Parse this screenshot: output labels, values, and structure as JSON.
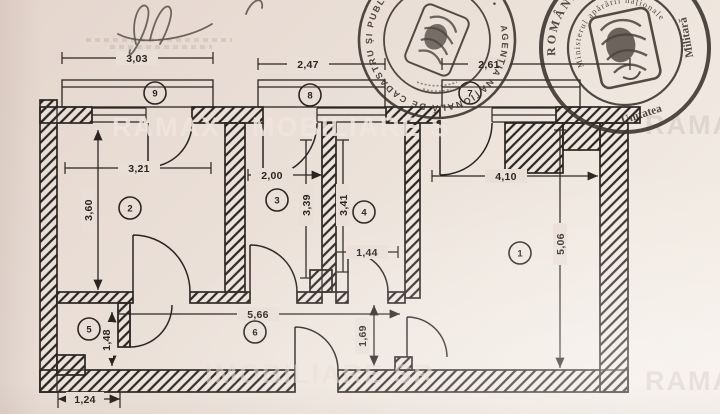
{
  "plan": {
    "rooms": [
      {
        "number": "1"
      },
      {
        "number": "2"
      },
      {
        "number": "3"
      },
      {
        "number": "4"
      },
      {
        "number": "5"
      },
      {
        "number": "6"
      },
      {
        "number": "7"
      },
      {
        "number": "8"
      },
      {
        "number": "9"
      }
    ],
    "dimensions": {
      "balcony_9_width": "3,03",
      "balcony_8_width": "2,47",
      "balcony_7_width": "2,61",
      "room_2_width": "3,21",
      "room_2_height": "3,60",
      "room_3_width": "2,00",
      "room_3_height": "3,39",
      "room_4_height": "3,41",
      "room_4_width": "1,44",
      "room_1_width": "4,10",
      "room_1_height": "5,06",
      "hall_length": "5,66",
      "room_5_height": "1,48",
      "hall_height": "1,69",
      "room_5_width": "1,24"
    }
  },
  "stamps": {
    "cadastre": {
      "ring_text": "AGENȚIA NAȚIONALĂ DE CADASTRU ȘI PUBLICITATE IMOBILIARĂ •"
    },
    "military": {
      "country": "ROMÂNIA",
      "number": "02547",
      "ministry": "Ministerul apărării naționale",
      "unit_line1": "Unitatea",
      "unit_line2": "Militară"
    }
  },
  "watermarks": {
    "top_left": "RAMAX",
    "top_mid": "MOBILIARE S",
    "top_right": "RAMAX F",
    "bottom_mid": "IMOBILIARE SR",
    "bottom_right": "RAMAX F"
  }
}
